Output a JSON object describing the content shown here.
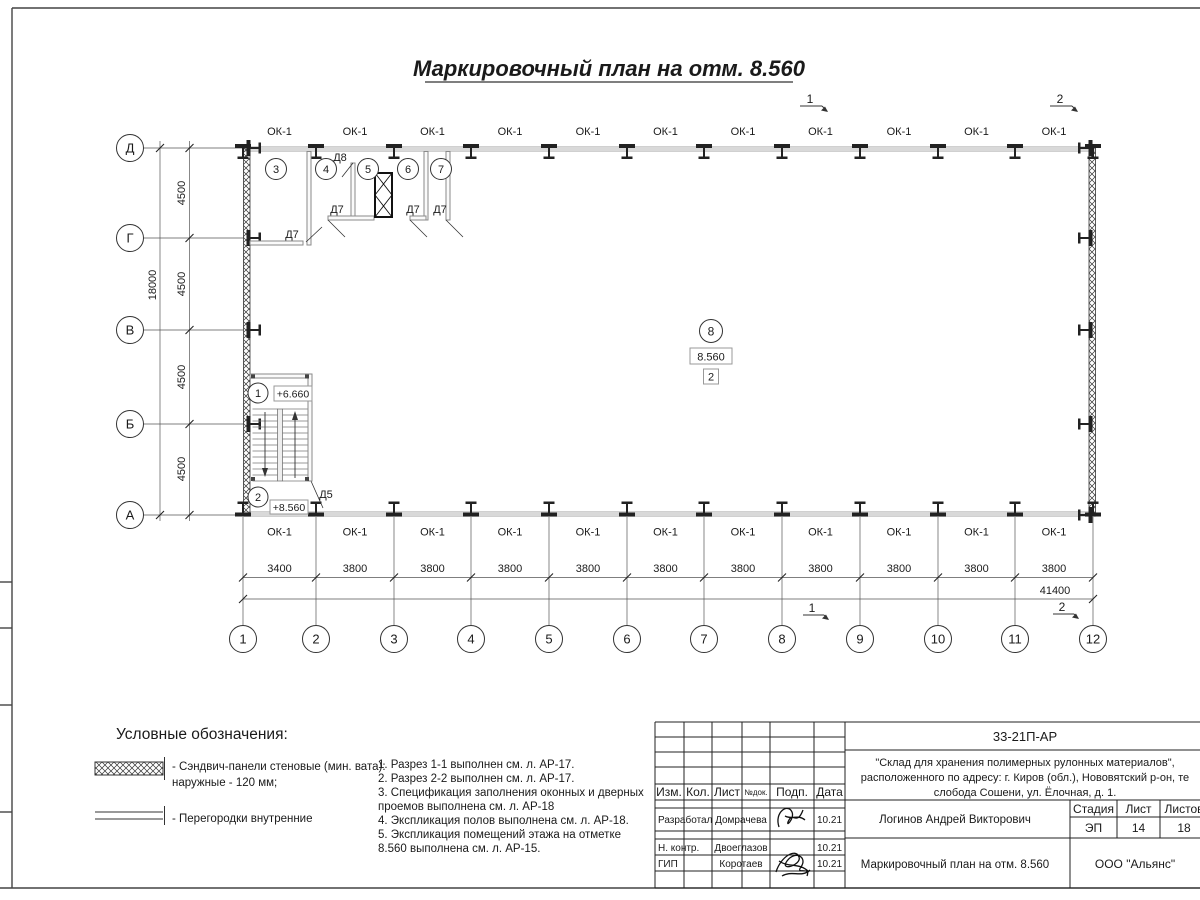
{
  "sheet": {
    "title": "Маркировочный план на отм. 8.560"
  },
  "plan": {
    "window_mark": "ОК-1",
    "row_axes": [
      "Д",
      "Г",
      "В",
      "Б",
      "А"
    ],
    "row_dims": [
      "4500",
      "4500",
      "4500",
      "4500"
    ],
    "row_total": "18000",
    "col_axes": [
      "1",
      "2",
      "3",
      "4",
      "5",
      "6",
      "7",
      "8",
      "9",
      "10",
      "11",
      "12"
    ],
    "col_dims": [
      "3400",
      "3800",
      "3800",
      "3800",
      "3800",
      "3800",
      "3800",
      "3800",
      "3800",
      "3800",
      "3800"
    ],
    "col_total": "41400",
    "rooms": [
      "1",
      "2",
      "3",
      "4",
      "5",
      "6",
      "7",
      "8"
    ],
    "marks": {
      "d5": "Д5",
      "d7": "Д7",
      "d8": "Д8"
    },
    "elev_upper": "+6.660",
    "elev_lower": "+8.560",
    "hall_elev": "8.560",
    "hall_zone": "2",
    "section1": "1",
    "section2": "2"
  },
  "legend": {
    "heading": "Условные обозначения:",
    "item1_line1": "- Сэндвич-панели стеновые (мин. вата):",
    "item1_line2": "наружные - 120 мм;",
    "item2": "- Перегородки внутренние"
  },
  "notes": {
    "line1": "1. Разрез 1-1 выполнен см. л. АР-17.",
    "line2": "2. Разрез 2-2 выполнен см. л. АР-17.",
    "line3": "3. Спецификация заполнения оконных и дверных",
    "line4": "проемов выполнена см. л. АР-18",
    "line5": "4. Экспликация полов выполнена см. л. АР-18.",
    "line6": "5.      Экспликация помещений этажа на отметке",
    "line7": "8.560 выполнена см. л. АР-15."
  },
  "titleblock": {
    "code": "33-21П-АР",
    "project_line1": "\"Склад для хранения полимерных рулонных материалов\",",
    "project_line2": "расположенного по адресу: г. Киров (обл.), Нововятский р-он, те",
    "project_line3": "слобода Сошени, ул. Ёлочная, д. 1.",
    "headers": {
      "izm": "Изм.",
      "kol": "Кол.",
      "list": "Лист",
      "ndoc": "№док.",
      "podp": "Подп.",
      "data": "Дата"
    },
    "rows": [
      {
        "role": "Разработал",
        "name": "Домрачева",
        "date": "10.21"
      },
      {
        "role": "Н. контр.",
        "name": "Двоеглазов",
        "date": "10.21"
      },
      {
        "role": "ГИП",
        "name": "Коротаев",
        "date": "10.21"
      }
    ],
    "chief": "Логинов Андрей Викторович",
    "doc_title": "Маркировочный план на отм. 8.560",
    "stage_label": "Стадия",
    "sheet_label": "Лист",
    "sheets_label": "Листов",
    "stage": "ЭП",
    "sheet_num": "14",
    "sheets_total": "18",
    "company": "ООО \"Альянс\""
  }
}
